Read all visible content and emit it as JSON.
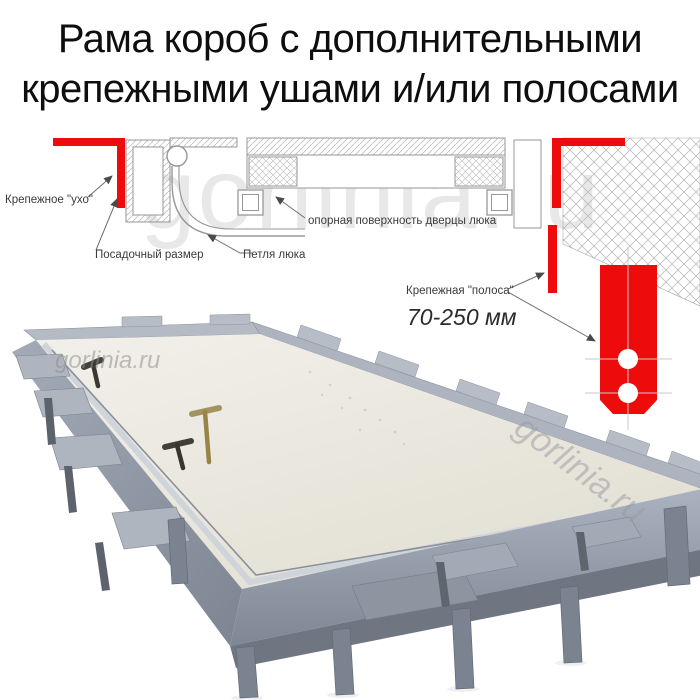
{
  "title": {
    "line1": "Рама короб с дополнительными",
    "line2": "крепежными ушами и/или полосами"
  },
  "watermark": {
    "text": "gorlinia.ru"
  },
  "diagram": {
    "labels": {
      "ear": "Крепежное \"ухо\"",
      "seat_size": "Посадочный размер",
      "hinge": "Петля люка",
      "support_surface": "опорная поверхность дверцы люка",
      "strip": "Крепежная \"полоса\"",
      "strip_range": "70-250 мм"
    },
    "colors": {
      "accent_red": "#ee0b0b",
      "drawing_line": "#979797",
      "panel_cream": "#e9e6dc",
      "frame_gray": "#9aa2af"
    }
  }
}
